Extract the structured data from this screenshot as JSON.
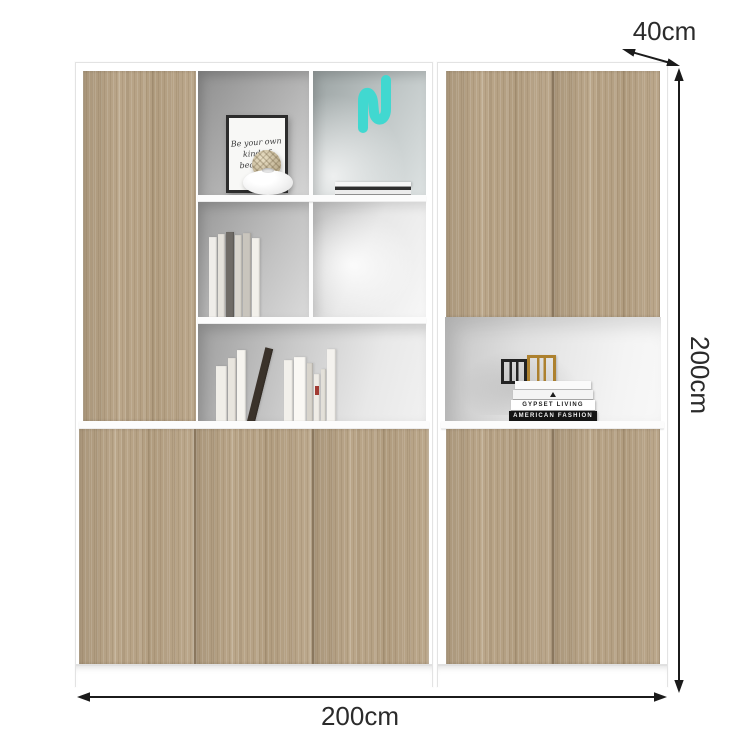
{
  "annotations": {
    "depth": {
      "label": "40cm"
    },
    "height": {
      "label": "200cm"
    },
    "width": {
      "label": "200cm"
    }
  },
  "palette": {
    "wood": "#b7a284",
    "frame_white": "#ffffff",
    "interior_grey": "#a9a9a9",
    "accent_teal": "#41d8d0",
    "annotation_line": "#1b1b1b",
    "annotation_text": "#2b2b2b"
  },
  "decor": {
    "picture_frame_text": "Be your own kind of beautiful",
    "stack_titles": {
      "gypset": "GYPSET LIVING",
      "fashion": "AMERICAN FASHION"
    }
  }
}
